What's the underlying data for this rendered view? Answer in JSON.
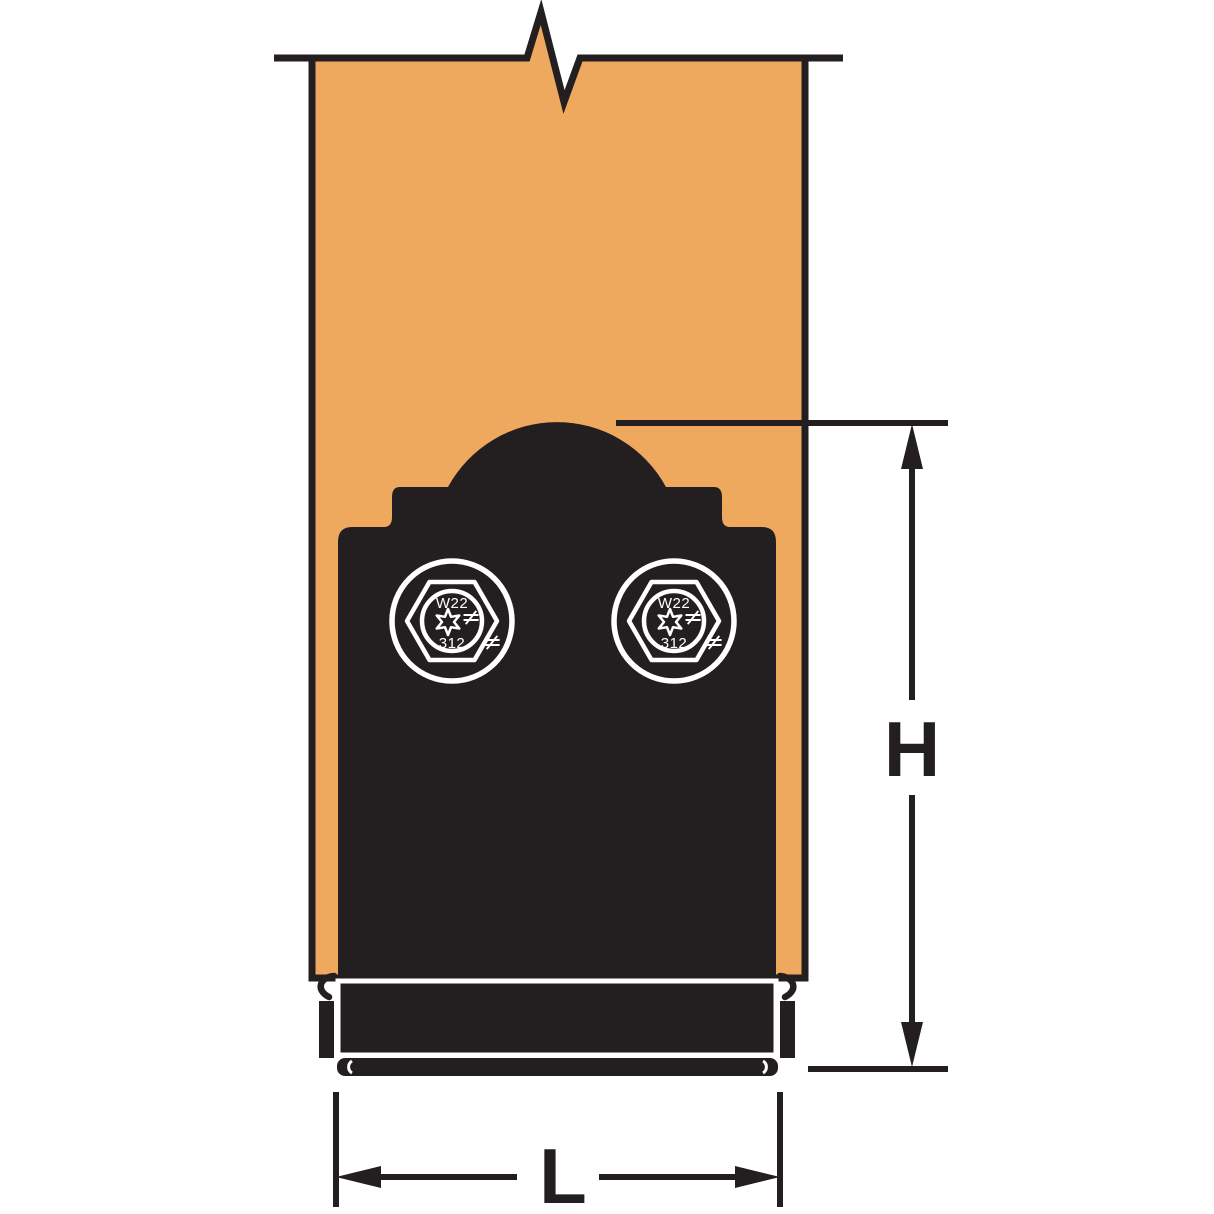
{
  "diagram": {
    "type": "technical-elevation-drawing",
    "subject": "decorative black post base hardware installed on wood post, with height and length dimensions",
    "labels": {
      "height_dim": "H",
      "length_dim": "L"
    },
    "bolt_washer": {
      "marking_top": "W22",
      "marking_bottom": "312",
      "mark_symbol_inner": "≠",
      "mark_symbol_outer": "≠"
    },
    "colors": {
      "post_fill": "#EFA95F",
      "hardware_fill": "#231F20",
      "line": "#231F20",
      "detail_line": "#FFFFFF",
      "background": "#FFFFFF"
    }
  }
}
